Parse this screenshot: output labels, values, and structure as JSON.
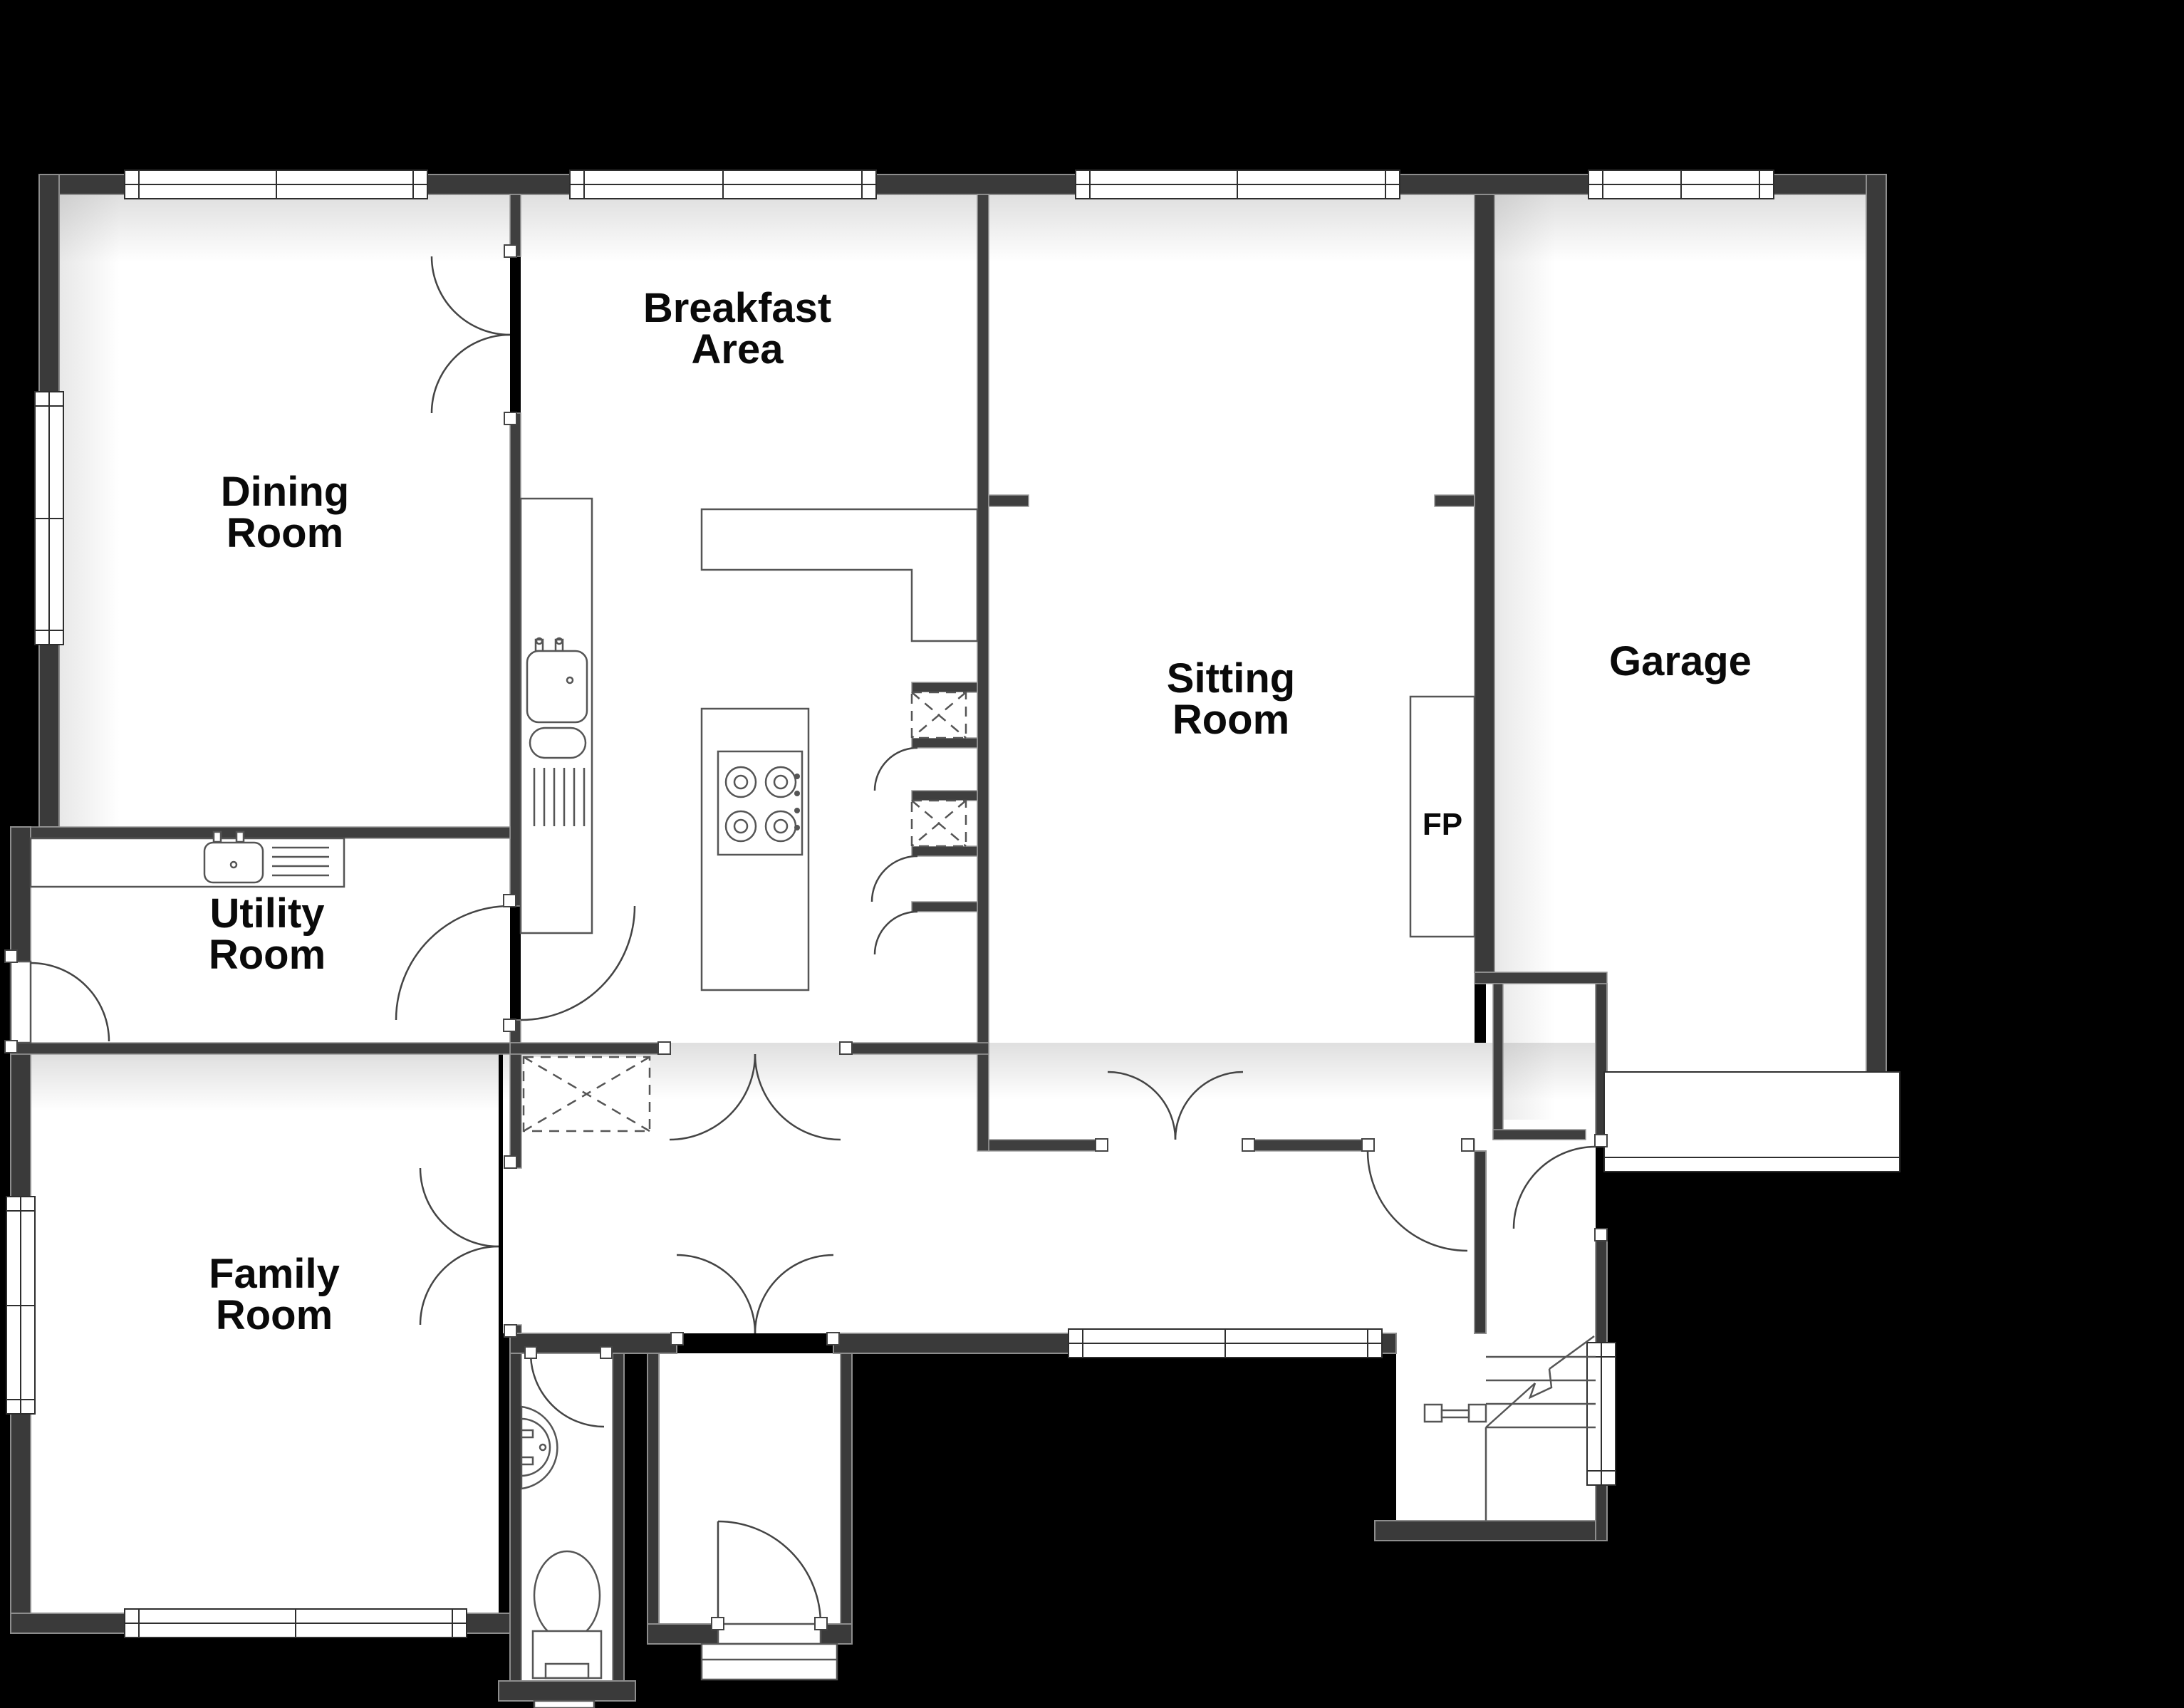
{
  "plan": {
    "title": "Ground floor plan",
    "rooms": [
      {
        "id": "dining",
        "line1": "Dining",
        "line2": "Room"
      },
      {
        "id": "breakfast",
        "line1": "Breakfast",
        "line2": "Area"
      },
      {
        "id": "sitting",
        "line1": "Sitting",
        "line2": "Room"
      },
      {
        "id": "garage",
        "line1": "Garage",
        "line2": ""
      },
      {
        "id": "utility",
        "line1": "Utility",
        "line2": "Room"
      },
      {
        "id": "family",
        "line1": "Family",
        "line2": "Room"
      }
    ],
    "fireplace_label": "FP",
    "colors": {
      "background": "#000000",
      "floor": "#ffffff",
      "wall": "#3a3a3a",
      "wall_edge": "#8d8d8d",
      "symbol_line": "#444444",
      "text": "#0a0a0a"
    },
    "fixtures": [
      "kitchen-sink-icon",
      "cooktop-hob-icon",
      "kitchen-island",
      "kitchen-counter",
      "utility-sink-icon",
      "wash-basin-icon",
      "toilet-icon",
      "staircase-icon",
      "fireplace",
      "garage-door",
      "storage-hatch-icon"
    ]
  }
}
